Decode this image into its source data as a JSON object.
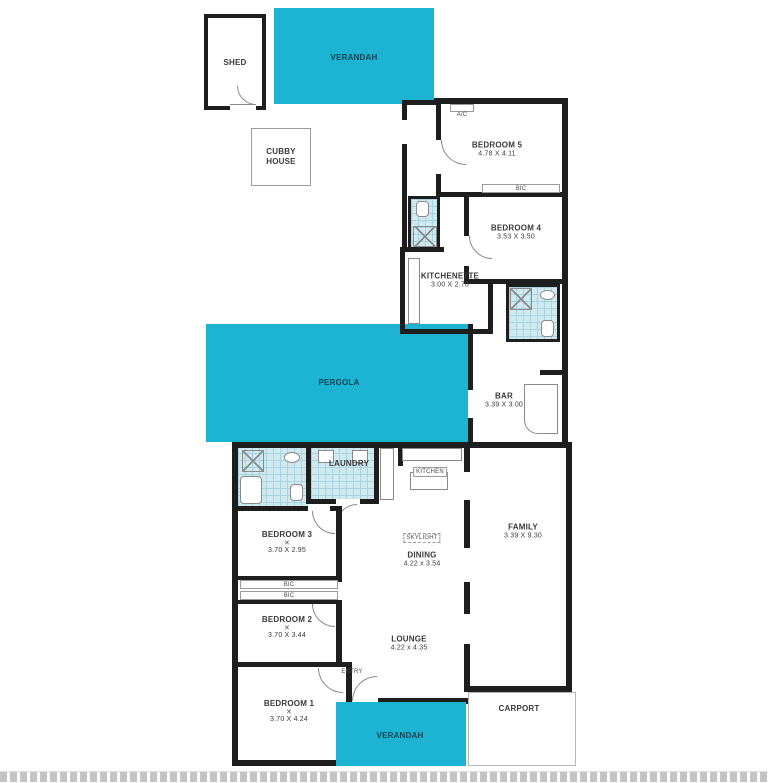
{
  "colors": {
    "accent": "#1cb4d2",
    "wall": "#1e1e1e",
    "tile": "#cfe9f0",
    "tile_line": "#a9d3de",
    "label": "#3a3a3a",
    "cyan_text": "#0b4455"
  },
  "rooms": {
    "shed": {
      "name": "SHED"
    },
    "verandah_top": {
      "name": "VERANDAH"
    },
    "cubby": {
      "line1": "CUBBY",
      "line2": "HOUSE"
    },
    "bedroom5": {
      "name": "BEDROOM 5",
      "dims": "4.78 X 4.11"
    },
    "bedroom4": {
      "name": "BEDROOM 4",
      "dims": "3.53 X 3.50"
    },
    "kitchenette": {
      "name": "KITCHENETTE",
      "dims": "3.00 X 2.70"
    },
    "pergola": {
      "name": "PERGOLA"
    },
    "bar": {
      "name": "BAR",
      "dims": "3.39 X 3.00"
    },
    "laundry": {
      "name": "LAUNDRY"
    },
    "bedroom3": {
      "name": "BEDROOM 3",
      "dims": "3.70 X 2.95"
    },
    "bedroom2": {
      "name": "BEDROOM 2",
      "dims": "3.70 X 3.44"
    },
    "bedroom1": {
      "name": "BEDROOM 1",
      "dims": "3.70 X 4.24"
    },
    "dining": {
      "name": "DINING",
      "dims": "4.22 x 3.54"
    },
    "kitchen": {
      "name": "KITCHEN"
    },
    "family": {
      "name": "FAMILY",
      "dims": "3.39 X 9.30"
    },
    "lounge": {
      "name": "LOUNGE",
      "dims": "4.22 x 4.35"
    },
    "entry": {
      "name": "ENTRY"
    },
    "carport": {
      "name": "CARPORT"
    },
    "verandah_bottom": {
      "name": "VERANDAH"
    }
  },
  "tags": {
    "ac": "A/C",
    "bic": "BIC",
    "skylight": "SKYLIGHT",
    "cross": "✕"
  }
}
